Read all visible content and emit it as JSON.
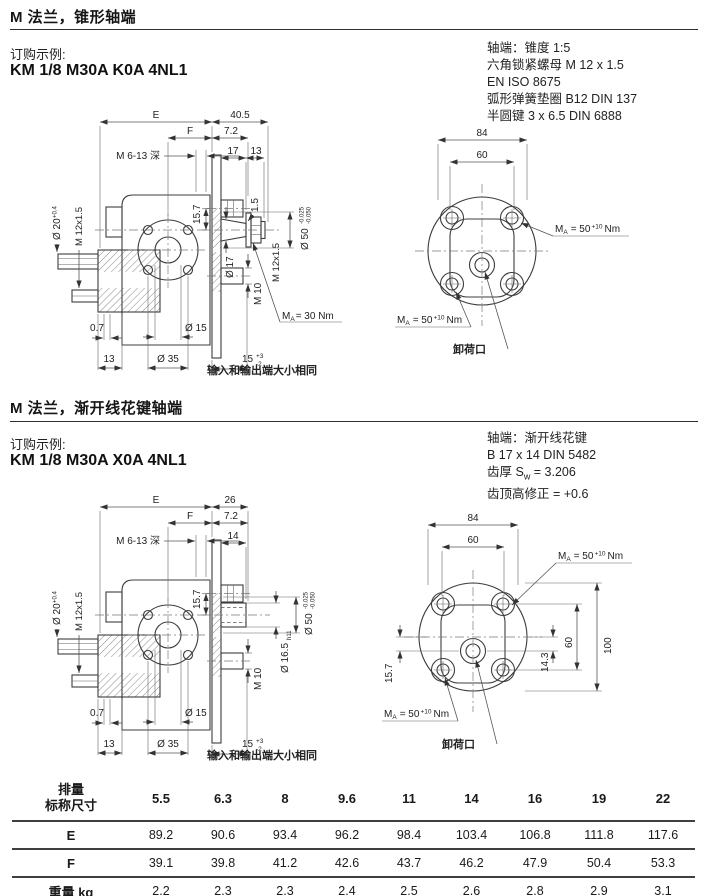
{
  "s1": {
    "title": "M 法兰，锥形轴端",
    "order_label": "订购示例:",
    "order_code": "KM 1/8 M30A K0A 4NL1",
    "notes": [
      "轴端：锥度 1:5",
      "六角锁紧螺母 M 12 x 1.5",
      "EN ISO 8675",
      "弧形弹簧垫圈 B12  DIN 137",
      "半圆键 3 x 6.5  DIN 6888"
    ],
    "side": {
      "len": "40.5",
      "d17": "17",
      "d13": "13",
      "d15": "1.5",
      "dia17": "Ø 17"
    }
  },
  "s2": {
    "title": "M 法兰，渐开线花键轴端",
    "order_label": "订购示例:",
    "order_code": "KM 1/8 M30A X0A 4NL1",
    "notes_line1": "轴端：渐开线花键",
    "notes_line2": "B 17 x 14  DIN 5482",
    "notes_line3a": "齿厚 S",
    "notes_line3b": "w",
    "notes_line3c": " = 3.206",
    "notes_line4": "齿顶高修正 = +0.6",
    "side": {
      "len": "26",
      "d14": "14",
      "dia165": "Ø 16.5",
      "h11": "h11"
    },
    "front": {
      "d143": "14.3",
      "d60": "60",
      "d100": "100",
      "d157": "15.7"
    }
  },
  "common": {
    "E": "E",
    "F": "F",
    "d72": "7.2",
    "m6": "M 6-13 深",
    "d157": "15.7",
    "dia50": "Ø 50",
    "tol_a": "-0.025",
    "tol_b": "-0.050",
    "m12": "M 12x1.5",
    "m10": "M 10",
    "d15": "15",
    "d15_sup": "+3",
    "d15_sub": "-2",
    "d07": "0.7",
    "d13": "13",
    "dia35": "Ø 35",
    "dia15": "Ø 15",
    "dia20": "Ø 20",
    "dia20_sup": "+0.4",
    "m12_left": "M 12x1.5",
    "d84": "84",
    "d60": "60",
    "tq": {
      "m": "M",
      "sub": "A",
      "eq": "= 50",
      "sup": "+10",
      "unit": "Nm"
    },
    "tq30": {
      "m": "M",
      "sub": "A",
      "eq": "= 30 Nm"
    },
    "relief": "卸荷口",
    "same": "输入和输出端大小相同"
  },
  "table": {
    "head_label_top": "排量",
    "head_label_bottom": "标称尺寸",
    "sizes": [
      "5.5",
      "6.3",
      "8",
      "9.6",
      "11",
      "14",
      "16",
      "19",
      "22"
    ],
    "rows": [
      {
        "label": "E",
        "values": [
          "89.2",
          "90.6",
          "93.4",
          "96.2",
          "98.4",
          "103.4",
          "106.8",
          "111.8",
          "117.6"
        ]
      },
      {
        "label": "F",
        "values": [
          "39.1",
          "39.8",
          "41.2",
          "42.6",
          "43.7",
          "46.2",
          "47.9",
          "50.4",
          "53.3"
        ]
      },
      {
        "label": "重量 kg",
        "values": [
          "2.2",
          "2.3",
          "2.3",
          "2.4",
          "2.5",
          "2.6",
          "2.8",
          "2.9",
          "3.1"
        ]
      }
    ]
  }
}
